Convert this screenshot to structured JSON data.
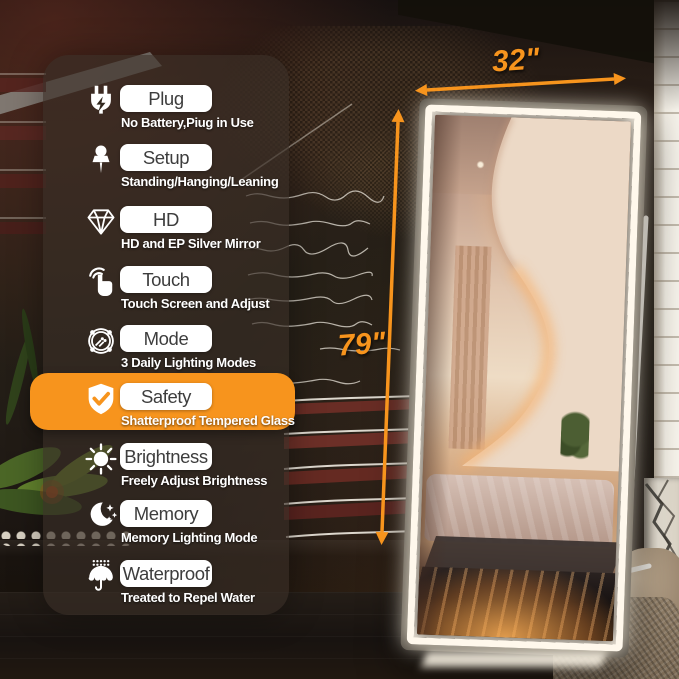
{
  "colors": {
    "accent_orange": "#F7941D",
    "led_white": "#FFF8EC"
  },
  "annotations": {
    "width_label": "32\"",
    "height_label": "79\""
  },
  "feature_panel": {
    "features": [
      {
        "icon": "plug-icon",
        "title": "Plug",
        "subtitle": "No Battery,Piug in Use",
        "highlighted": false
      },
      {
        "icon": "pushpin-icon",
        "title": "Setup",
        "subtitle": "Standing/Hanging/Leaning",
        "highlighted": false
      },
      {
        "icon": "diamond-icon",
        "title": "HD",
        "subtitle": "HD and EP Silver Mirror",
        "highlighted": false
      },
      {
        "icon": "touch-icon",
        "title": "Touch",
        "subtitle": "Touch Screen and Adjust",
        "highlighted": false
      },
      {
        "icon": "mode-icon",
        "title": "Mode",
        "subtitle": "3 Daily Lighting Modes",
        "highlighted": false
      },
      {
        "icon": "shield-icon",
        "title": "Safety",
        "subtitle": "Shatterproof Tempered Glass",
        "highlighted": true
      },
      {
        "icon": "sun-icon",
        "title": "Brightness",
        "subtitle": "Freely Adjust Brightness",
        "highlighted": false
      },
      {
        "icon": "moon-icon",
        "title": "Memory",
        "subtitle": "Memory Lighting Mode",
        "highlighted": false
      },
      {
        "icon": "umbrella-icon",
        "title": "Waterproof",
        "subtitle": "Treated to Repel Water",
        "highlighted": false
      }
    ]
  }
}
